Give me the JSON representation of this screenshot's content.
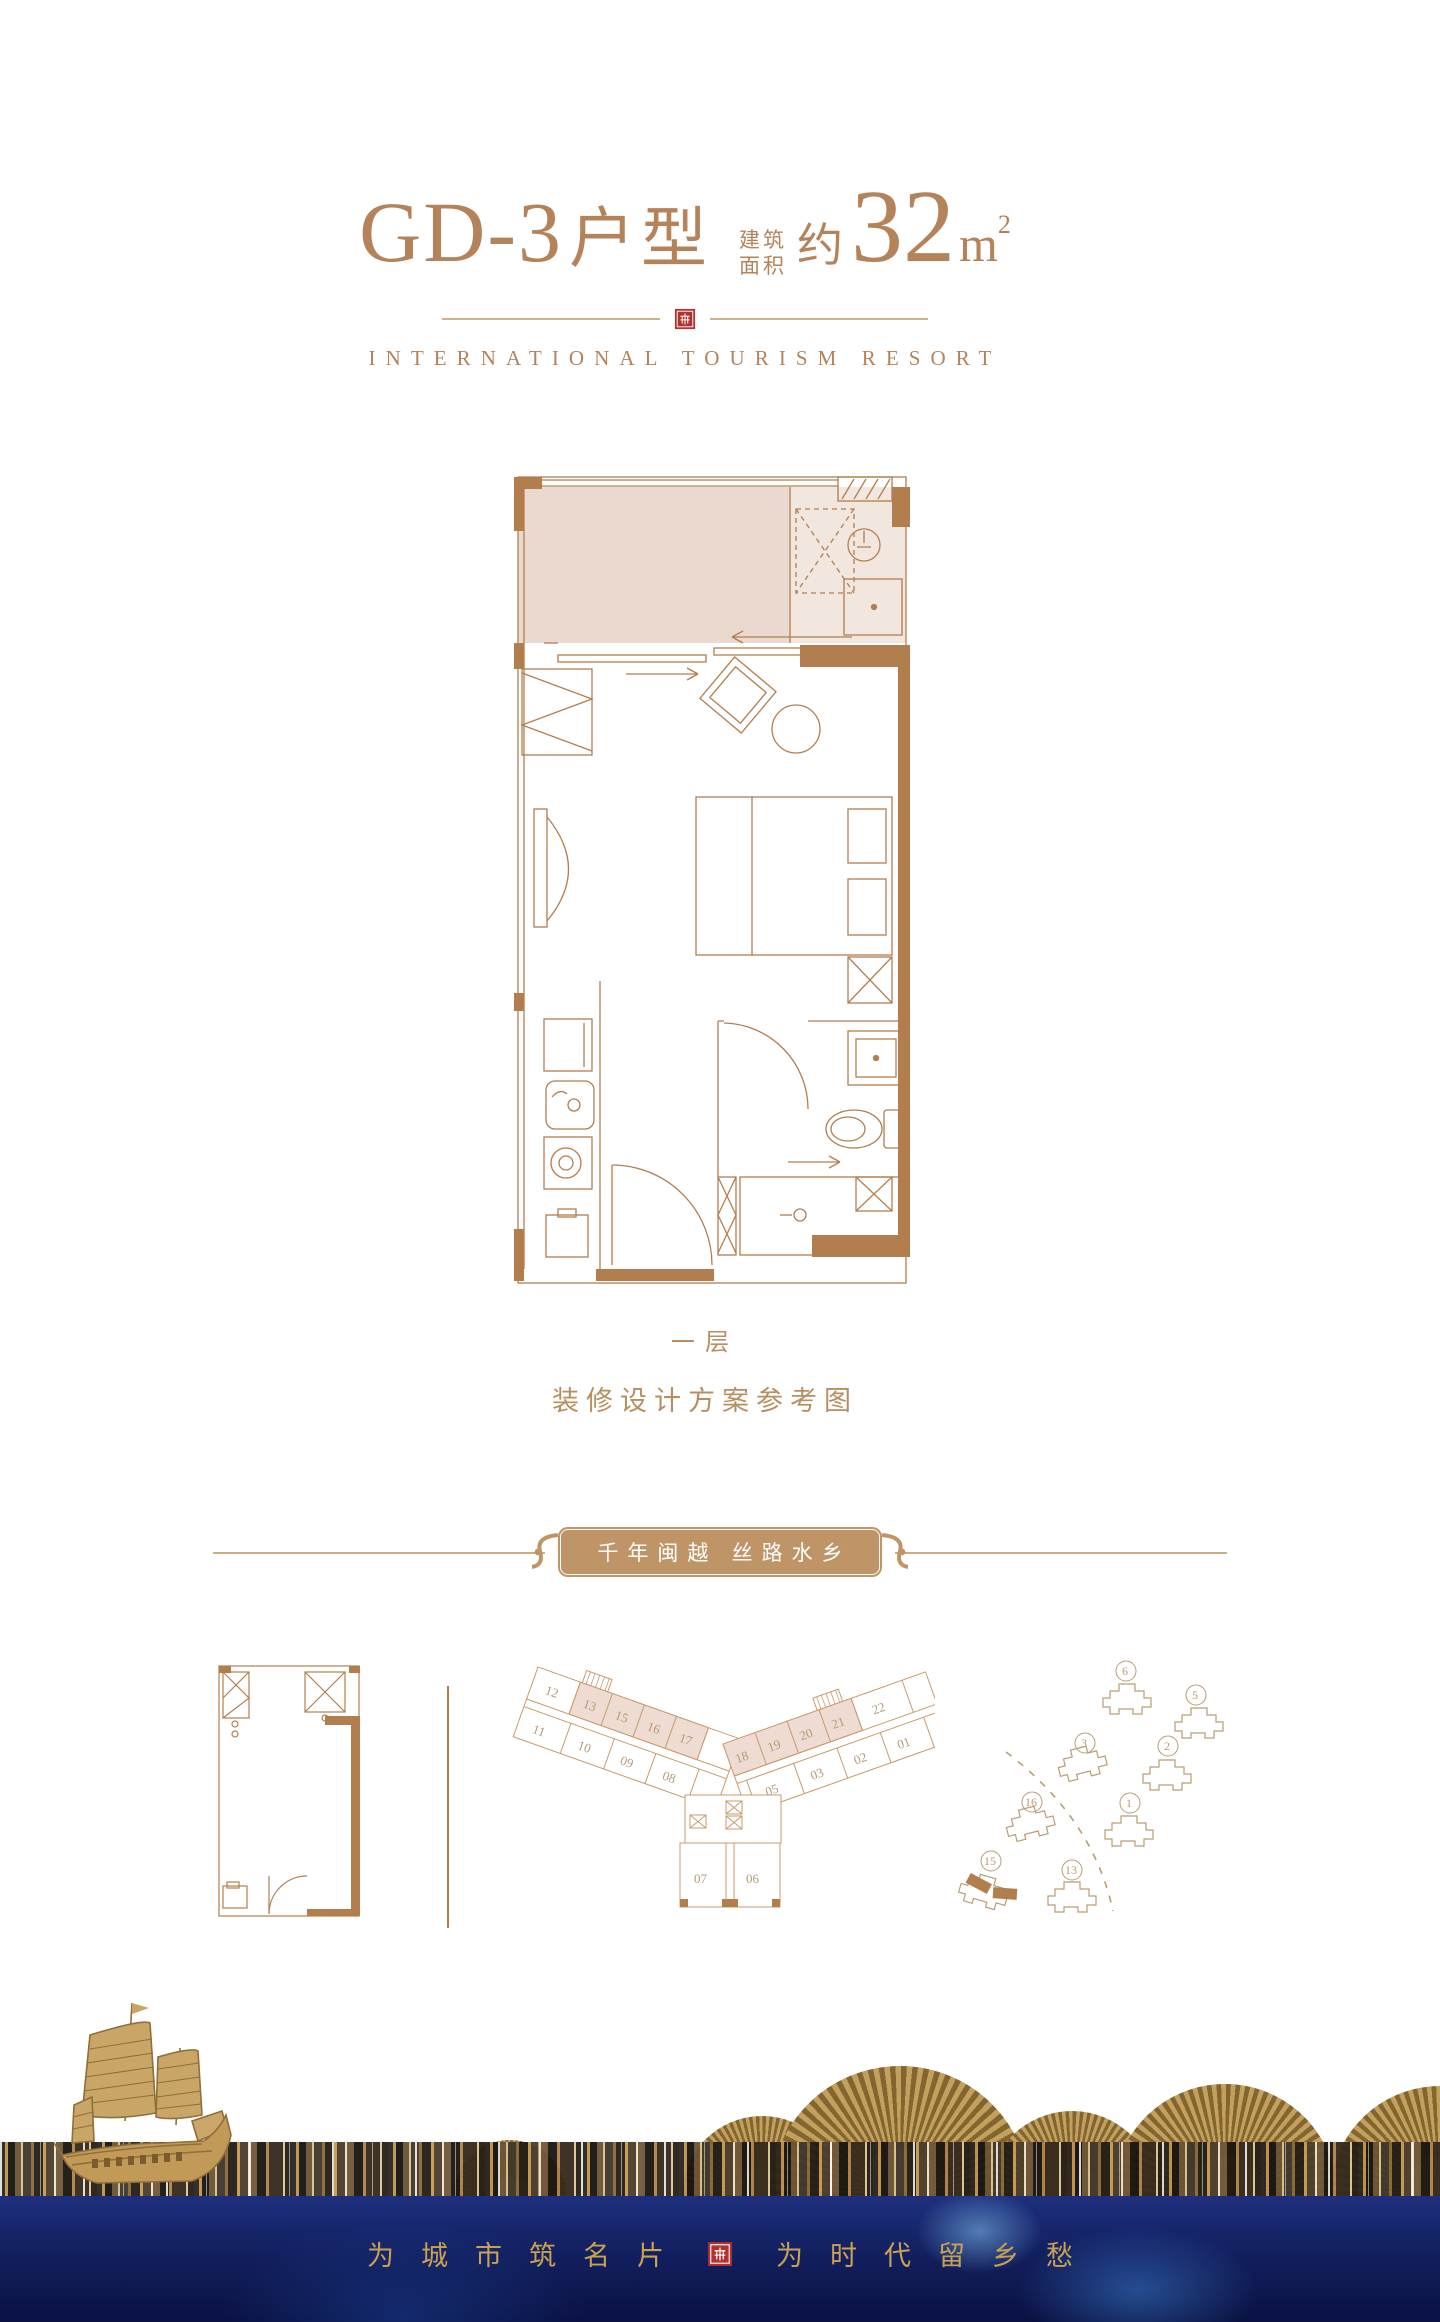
{
  "colors": {
    "accent": "#b5835a",
    "wall_brown": "#b27e4e",
    "balcony_beige": "#ead9cf",
    "banner_tan": "#bf9466",
    "seal_red": "#b23230",
    "slogan_gold": "#c9a153",
    "water_deep": "#0a1142",
    "fan_gold": "#c2a05e"
  },
  "header": {
    "unit_code": "GD-3",
    "unit_type_label": "户型",
    "area_label_top": "建筑",
    "area_label_bottom": "面积",
    "area_prefix": "约",
    "area_value": "32",
    "area_unit": "m",
    "area_superscript": "2",
    "subtitle": "INTERNATIONAL TOURISM RESORT"
  },
  "unit_plan": {
    "floor_caption": "一层",
    "note_caption": "装修设计方案参考图"
  },
  "banner": {
    "text": "千年闽越 丝路水乡"
  },
  "plate": {
    "left_top": [
      "12",
      "13",
      "15",
      "16",
      "17"
    ],
    "left_bottom": [
      "11",
      "10",
      "09",
      "08"
    ],
    "right_top": [
      "18",
      "19",
      "20",
      "21",
      "22"
    ],
    "right_bottom": [
      "05",
      "03",
      "02",
      "01"
    ],
    "center": [
      "07",
      "06"
    ]
  },
  "site": {
    "buildings": [
      "6",
      "5",
      "3",
      "2",
      "16",
      "1",
      "15",
      "13"
    ],
    "highlighted_building": "15"
  },
  "footer": {
    "slogan_left": "为城市筑名片",
    "slogan_right": "为时代留乡愁"
  }
}
